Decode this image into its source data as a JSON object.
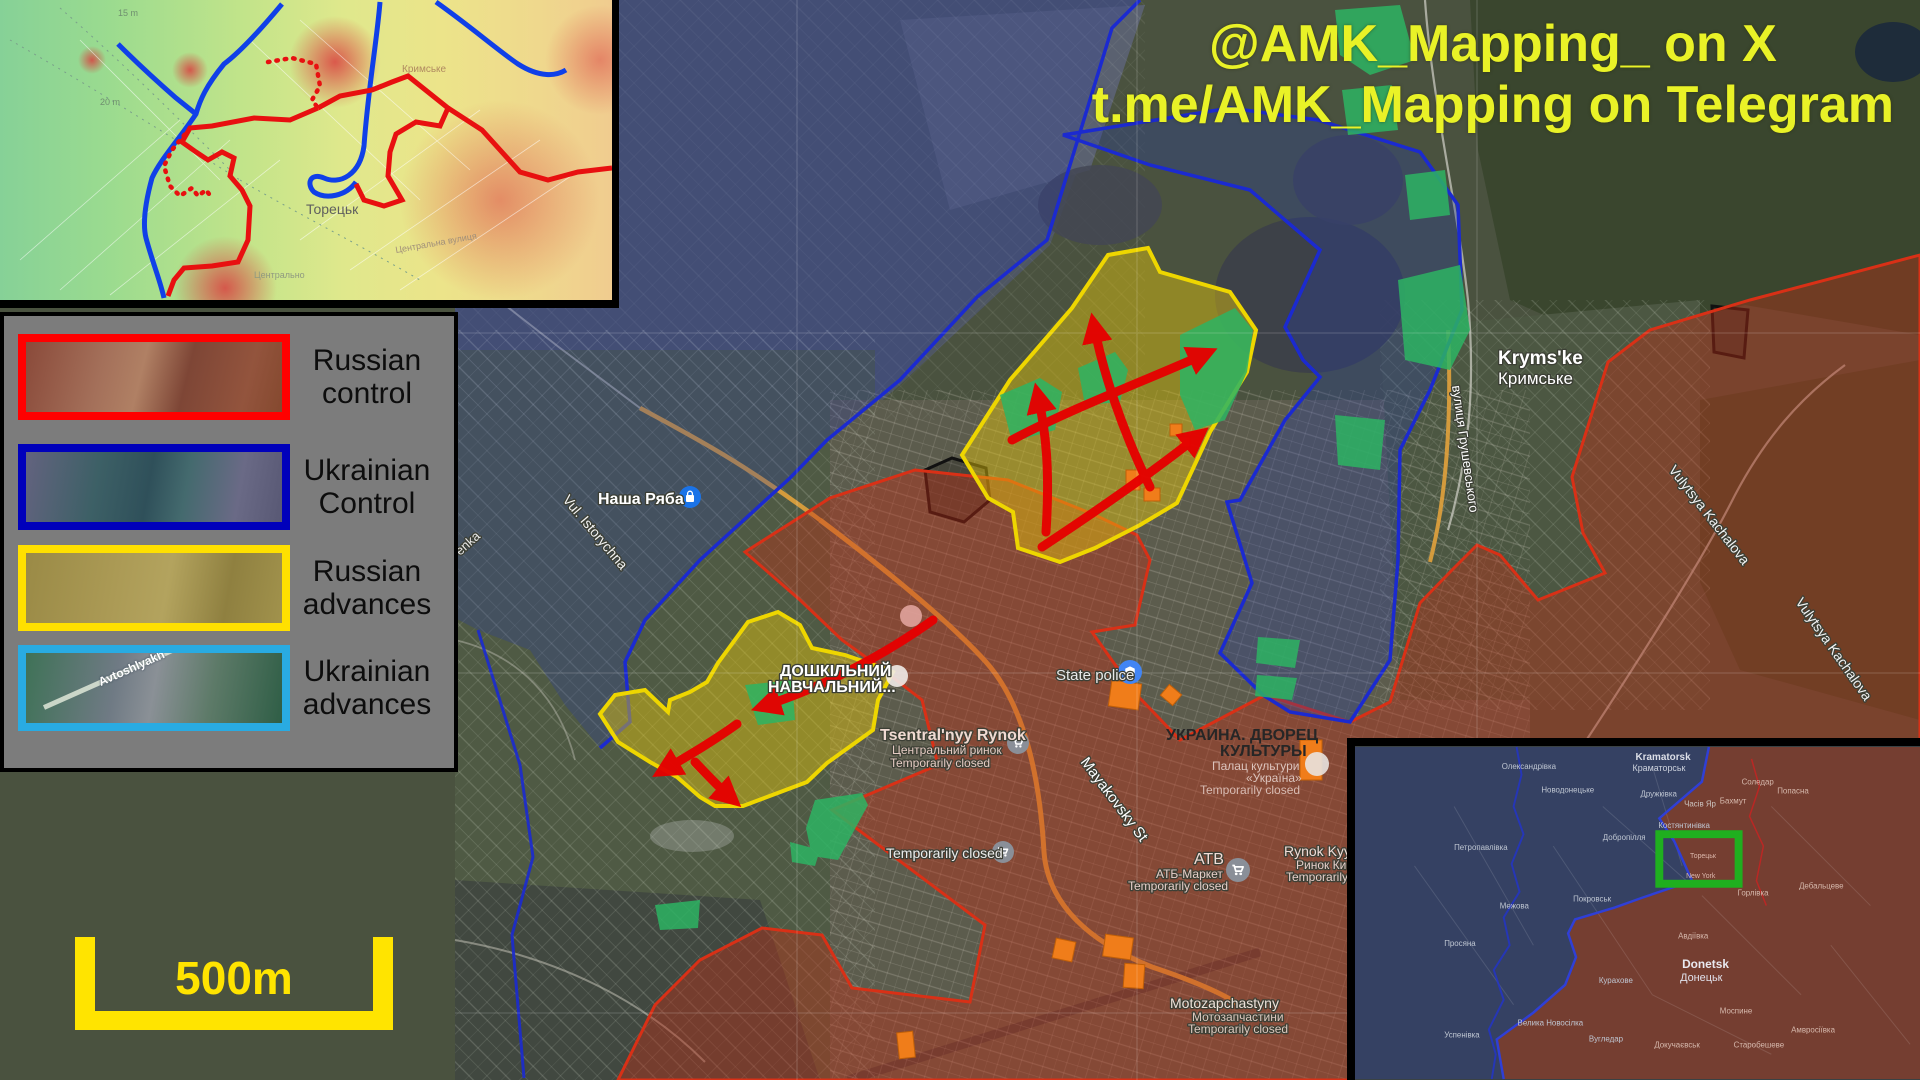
{
  "attribution": {
    "line1": "@AMK_Mapping_ on X",
    "line2": "t.me/AMK_Mapping on Telegram"
  },
  "legend": {
    "items": [
      {
        "line1": "Russian",
        "line2": "control"
      },
      {
        "line1": "Ukrainian",
        "line2": "Control"
      },
      {
        "line1": "Russian",
        "line2": "advances"
      },
      {
        "line1": "Ukrainian",
        "line2": "advances"
      }
    ],
    "swatch_road_label": "Avtoshlyakh"
  },
  "scale_bar": {
    "label": "500m"
  },
  "colors": {
    "russian_control_border": "#ff0000",
    "ukrainian_control_border": "#0000bb",
    "russian_advance_border": "#ffe000",
    "ukrainian_advance_border": "#29abe2",
    "advance_arrow": "#e60000",
    "attribution_text": "#e9f227",
    "scale_bar": "#ffe400",
    "overview_highlight_box": "#1faf1f"
  },
  "main_map": {
    "labels": [
      {
        "n": "label-nasha-ryaba",
        "t": "Наша Ряба",
        "x": 598,
        "y": 504,
        "s": 16,
        "c": "#ffffff",
        "w": 700,
        "halo": 1
      },
      {
        "n": "label-vul-istorychna",
        "t": "Vul. Istorychna",
        "x": 562,
        "y": 500,
        "s": 14,
        "c": "#f2f2f2",
        "r": 50,
        "halo": 1
      },
      {
        "n": "label-street-enka",
        "t": "enka",
        "x": 460,
        "y": 556,
        "s": 13,
        "c": "#e8e8e8",
        "r": -42,
        "halo": 1
      },
      {
        "n": "label-krymske-en",
        "t": "Kryms'ke",
        "x": 1498,
        "y": 364,
        "s": 19,
        "c": "#ffffff",
        "w": 700,
        "halo": 1
      },
      {
        "n": "label-krymske-ua",
        "t": "Кримське",
        "x": 1498,
        "y": 384,
        "s": 17,
        "c": "#ffffff",
        "halo": 1
      },
      {
        "n": "label-hrushevskoho-street",
        "t": "вулиця Грушевського",
        "x": 1452,
        "y": 386,
        "s": 13,
        "c": "#ffffff",
        "r": 82,
        "halo": 1
      },
      {
        "n": "label-kachalova-street-1",
        "t": "Vulytsya Kachalova",
        "x": 1668,
        "y": 470,
        "s": 14,
        "c": "#f2f2f2",
        "r": 52,
        "halo": 1
      },
      {
        "n": "label-kachalova-street-2",
        "t": "Vulytsya Kachalova",
        "x": 1795,
        "y": 602,
        "s": 14,
        "c": "#f2f2f2",
        "r": 55,
        "halo": 1
      },
      {
        "n": "label-state-police",
        "t": "State police",
        "x": 1056,
        "y": 680,
        "s": 15,
        "c": "#e9e9e9",
        "halo": 1
      },
      {
        "n": "label-tsentralnyy-rynok",
        "t": "Tsentral'nyy Rynok",
        "x": 880,
        "y": 740,
        "s": 16,
        "c": "#f0dad2",
        "w": 700,
        "halo": 1
      },
      {
        "n": "label-tsentralnyy-rynok-ua",
        "t": "Центральний ринок",
        "x": 892,
        "y": 754,
        "s": 12,
        "c": "#e4cac2",
        "halo": 1
      },
      {
        "n": "label-tsentralnyy-rynok-closed",
        "t": "Temporarily closed",
        "x": 890,
        "y": 767,
        "s": 12,
        "c": "#e4cac2",
        "halo": 1
      },
      {
        "n": "label-mayakovsky-street",
        "t": "Mayakovsky St",
        "x": 1080,
        "y": 762,
        "s": 15,
        "c": "#ffffff",
        "r": 53,
        "halo": 1
      },
      {
        "n": "label-palace-title-1",
        "t": "УКРАИНА. ДВОРЕЦ",
        "x": 1166,
        "y": 740,
        "s": 16,
        "c": "#262626",
        "w": 700
      },
      {
        "n": "label-palace-title-2",
        "t": "КУЛЬТУРЫ",
        "x": 1220,
        "y": 756,
        "s": 16,
        "c": "#262626",
        "w": 700
      },
      {
        "n": "label-palace-sub-1",
        "t": "Палац культури",
        "x": 1212,
        "y": 770,
        "s": 12,
        "c": "#dcc4bd"
      },
      {
        "n": "label-palace-sub-2",
        "t": "«Україна»",
        "x": 1246,
        "y": 782,
        "s": 12,
        "c": "#dcc4bd"
      },
      {
        "n": "label-palace-closed",
        "t": "Temporarily closed",
        "x": 1200,
        "y": 794,
        "s": 12,
        "c": "#d8bcb4"
      },
      {
        "n": "label-temporarily-closed",
        "t": "Temporarily closed",
        "x": 886,
        "y": 858,
        "s": 14,
        "c": "#ececec",
        "halo": 1
      },
      {
        "n": "label-atb",
        "t": "АТВ",
        "x": 1194,
        "y": 864,
        "s": 16,
        "c": "#f0dcd6",
        "halo": 1
      },
      {
        "n": "label-atb-market",
        "t": "АТБ-Маркет",
        "x": 1156,
        "y": 878,
        "s": 12,
        "c": "#e6cec8",
        "halo": 1
      },
      {
        "n": "label-atb-closed",
        "t": "Temporarily closed",
        "x": 1128,
        "y": 890,
        "s": 12,
        "c": "#e6cec8",
        "halo": 1
      },
      {
        "n": "label-rynok-kyy",
        "t": "Rynok Kyy",
        "x": 1284,
        "y": 856,
        "s": 14,
        "c": "#f0dcd6",
        "halo": 1
      },
      {
        "n": "label-rynok-kyy-ua",
        "t": "Ринок Ки",
        "x": 1296,
        "y": 869,
        "s": 12,
        "c": "#e6cec8",
        "halo": 1
      },
      {
        "n": "label-rynok-kyy-closed",
        "t": "Temporarily clos",
        "x": 1286,
        "y": 881,
        "s": 12,
        "c": "#e6cec8",
        "halo": 1
      },
      {
        "n": "label-motozapchastyny",
        "t": "Motozapchastyny",
        "x": 1170,
        "y": 1008,
        "s": 14,
        "c": "#eee2da",
        "halo": 1
      },
      {
        "n": "label-motozapchastyny-ua",
        "t": "Мотозапчастини",
        "x": 1192,
        "y": 1021,
        "s": 12,
        "c": "#dcc8be",
        "halo": 1
      },
      {
        "n": "label-motozapchastyny-closed",
        "t": "Temporarily closed",
        "x": 1188,
        "y": 1033,
        "s": 12,
        "c": "#dcc8be",
        "halo": 1
      },
      {
        "n": "label-doshkilnyi-1",
        "t": "ДОШКІЛЬНИЙ",
        "x": 780,
        "y": 676,
        "s": 16,
        "c": "#ffffff",
        "w": 700,
        "halo": 1
      },
      {
        "n": "label-doshkilnyi-2",
        "t": "НАВЧАЛЬНИЙ...",
        "x": 768,
        "y": 692,
        "s": 16,
        "c": "#ffffff",
        "w": 700,
        "halo": 1
      }
    ]
  },
  "topo_inset": {
    "labels": [
      {
        "n": "topo-label-toretsk",
        "t": "Торецьк",
        "x": 306,
        "y": 214,
        "s": 14,
        "c": "#5f5f5f"
      },
      {
        "n": "topo-label-krymske",
        "t": "Кримське",
        "x": 402,
        "y": 72,
        "s": 10,
        "c": "#b08a60"
      },
      {
        "n": "topo-label-20m",
        "t": "20 m",
        "x": 100,
        "y": 105,
        "s": 9,
        "c": "#6f8f6f"
      },
      {
        "n": "topo-label-15m",
        "t": "15 m",
        "x": 118,
        "y": 16,
        "s": 9,
        "c": "#6f8f6f"
      },
      {
        "n": "topo-label-tsentralna-street",
        "t": "Центральна вулиця",
        "x": 396,
        "y": 253,
        "s": 9,
        "c": "#a08f7a",
        "r": -10
      },
      {
        "n": "topo-label-tsentralno",
        "t": "Центрально",
        "x": 254,
        "y": 278,
        "s": 9,
        "c": "#909a80"
      }
    ]
  },
  "overview_inset": {
    "labels": [
      {
        "n": "ov-label-oleksandrivka",
        "t": "Олександрівка",
        "x": 148,
        "y": 22,
        "c": "#bfc6d2"
      },
      {
        "n": "ov-label-kramatorsk-en",
        "t": "Kramatorsk",
        "x": 283,
        "y": 13,
        "s": 10,
        "w": 700,
        "c": "#dcdfe8"
      },
      {
        "n": "ov-label-kramatorsk-ua",
        "t": "Краматорськ",
        "x": 280,
        "y": 24,
        "s": 9,
        "c": "#ccd1dc"
      },
      {
        "n": "ov-label-novodonetske",
        "t": "Новодонецьке",
        "x": 188,
        "y": 46,
        "c": "#bfc6d2"
      },
      {
        "n": "ov-label-druzhkivka",
        "t": "Дружківка",
        "x": 288,
        "y": 50,
        "c": "#bfc6d2"
      },
      {
        "n": "ov-label-chasiv-yar",
        "t": "Часів Яр",
        "x": 332,
        "y": 60,
        "c": "#ccc4c0"
      },
      {
        "n": "ov-label-bakhmut",
        "t": "Бахмут",
        "x": 368,
        "y": 57,
        "c": "#d6b9ad"
      },
      {
        "n": "ov-label-soledar",
        "t": "Соледар",
        "x": 390,
        "y": 38,
        "c": "#d6b9ad"
      },
      {
        "n": "ov-label-popasna",
        "t": "Попасна",
        "x": 426,
        "y": 47,
        "c": "#d6b9ad"
      },
      {
        "n": "ov-label-kostyantynivka",
        "t": "Костянтинівка",
        "x": 306,
        "y": 82,
        "c": "#bfc6d2"
      },
      {
        "n": "ov-label-dobropillya",
        "t": "Добропілля",
        "x": 250,
        "y": 94,
        "c": "#bfc6d2"
      },
      {
        "n": "ov-label-petropavlivka",
        "t": "Петропавлівка",
        "x": 100,
        "y": 104,
        "c": "#bfc6d2"
      },
      {
        "n": "ov-label-toretsk",
        "t": "Торецьк",
        "x": 338,
        "y": 112,
        "s": 7,
        "c": "#dcb8ac"
      },
      {
        "n": "ov-label-new-york",
        "t": "New York",
        "x": 334,
        "y": 132,
        "s": 7,
        "c": "#dcb8ac"
      },
      {
        "n": "ov-label-horlivka",
        "t": "Горлівка",
        "x": 386,
        "y": 150,
        "c": "#d6b9ad"
      },
      {
        "n": "ov-label-debaltseve",
        "t": "Дебальцеве",
        "x": 448,
        "y": 143,
        "c": "#d6b9ad"
      },
      {
        "n": "ov-label-pokrovsk",
        "t": "Покровськ",
        "x": 220,
        "y": 156,
        "c": "#bfc6d2"
      },
      {
        "n": "ov-label-mezhova",
        "t": "Межова",
        "x": 146,
        "y": 163,
        "c": "#bfc6d2"
      },
      {
        "n": "ov-label-avdiivka",
        "t": "Авдіївка",
        "x": 326,
        "y": 193,
        "c": "#d6b9ad"
      },
      {
        "n": "ov-label-prosiana",
        "t": "Просяна",
        "x": 90,
        "y": 201,
        "c": "#bfc6d2"
      },
      {
        "n": "ov-label-donetsk-en",
        "t": "Donetsk",
        "x": 330,
        "y": 223,
        "s": 12,
        "w": 700,
        "c": "#e9e9f0"
      },
      {
        "n": "ov-label-donetsk-ua",
        "t": "Донецьк",
        "x": 328,
        "y": 236,
        "s": 11,
        "c": "#e0e0ea"
      },
      {
        "n": "ov-label-kurakhove",
        "t": "Курахове",
        "x": 246,
        "y": 238,
        "c": "#bfc6d2"
      },
      {
        "n": "ov-label-mospyne",
        "t": "Моспине",
        "x": 368,
        "y": 269,
        "c": "#d6b9ad"
      },
      {
        "n": "ov-label-velyka-novosilka",
        "t": "Велика Новосілка",
        "x": 164,
        "y": 281,
        "c": "#bfc6d2"
      },
      {
        "n": "ov-label-uspenivka",
        "t": "Успенівка",
        "x": 90,
        "y": 293,
        "c": "#bfc6d2"
      },
      {
        "n": "ov-label-vuhledar",
        "t": "Вугледар",
        "x": 236,
        "y": 297,
        "c": "#bfc6d2"
      },
      {
        "n": "ov-label-dokuchajevsk",
        "t": "Докучаєвськ",
        "x": 302,
        "y": 303,
        "c": "#d6b9ad"
      },
      {
        "n": "ov-label-starobesheve",
        "t": "Старобешеве",
        "x": 382,
        "y": 303,
        "c": "#d6b9ad"
      },
      {
        "n": "ov-label-amvrosiivka",
        "t": "Амвросіївка",
        "x": 440,
        "y": 288,
        "c": "#d6b9ad"
      }
    ]
  }
}
